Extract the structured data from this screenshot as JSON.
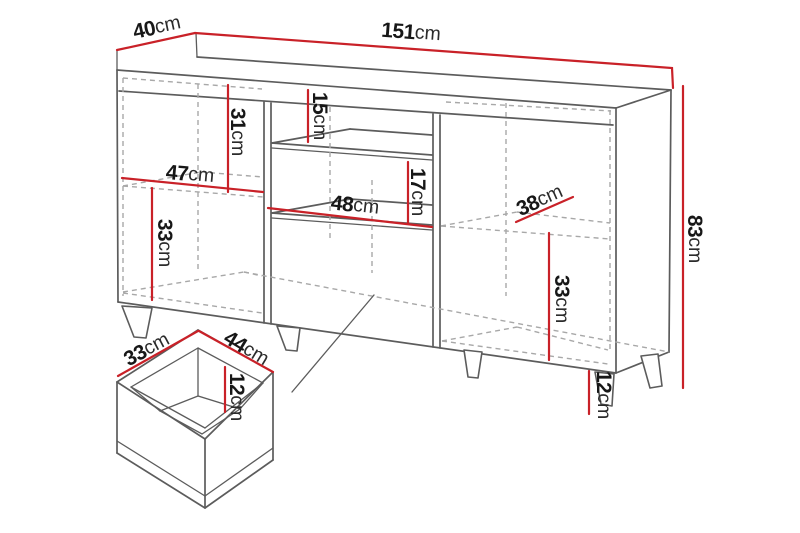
{
  "meta": {
    "description": "Technical dimension diagram of a sideboard cabinet with drawer detail",
    "unit": "cm"
  },
  "colors": {
    "measure": "#c92128",
    "outline": "#5c5c5c",
    "hidden": "#a8a8a8",
    "text": "#171717",
    "background": "#ffffff"
  },
  "diagram": {
    "type": "furniture-dimension-drawing",
    "overall": {
      "width_cm": 151,
      "depth_cm": 40,
      "height_cm": 83,
      "leg_height_cm": 12
    },
    "measurements": {
      "depth": {
        "value": "40",
        "unit": "cm"
      },
      "width": {
        "value": "151",
        "unit": "cm"
      },
      "height": {
        "value": "83",
        "unit": "cm"
      },
      "left_top_compartment_height": {
        "value": "31",
        "unit": "cm"
      },
      "left_compartment_width": {
        "value": "47",
        "unit": "cm"
      },
      "left_bottom_compartment_height": {
        "value": "33",
        "unit": "cm"
      },
      "middle_top_shelf_gap": {
        "value": "15",
        "unit": "cm"
      },
      "middle_bottom_shelf_gap": {
        "value": "17",
        "unit": "cm"
      },
      "middle_compartment_width": {
        "value": "48",
        "unit": "cm"
      },
      "right_shelf_depth": {
        "value": "38",
        "unit": "cm"
      },
      "right_bottom_compartment_height": {
        "value": "33",
        "unit": "cm"
      },
      "leg_height": {
        "value": "12",
        "unit": "cm"
      },
      "drawer_depth": {
        "value": "33",
        "unit": "cm"
      },
      "drawer_width": {
        "value": "44",
        "unit": "cm"
      },
      "drawer_inner_height": {
        "value": "12",
        "unit": "cm"
      }
    }
  }
}
